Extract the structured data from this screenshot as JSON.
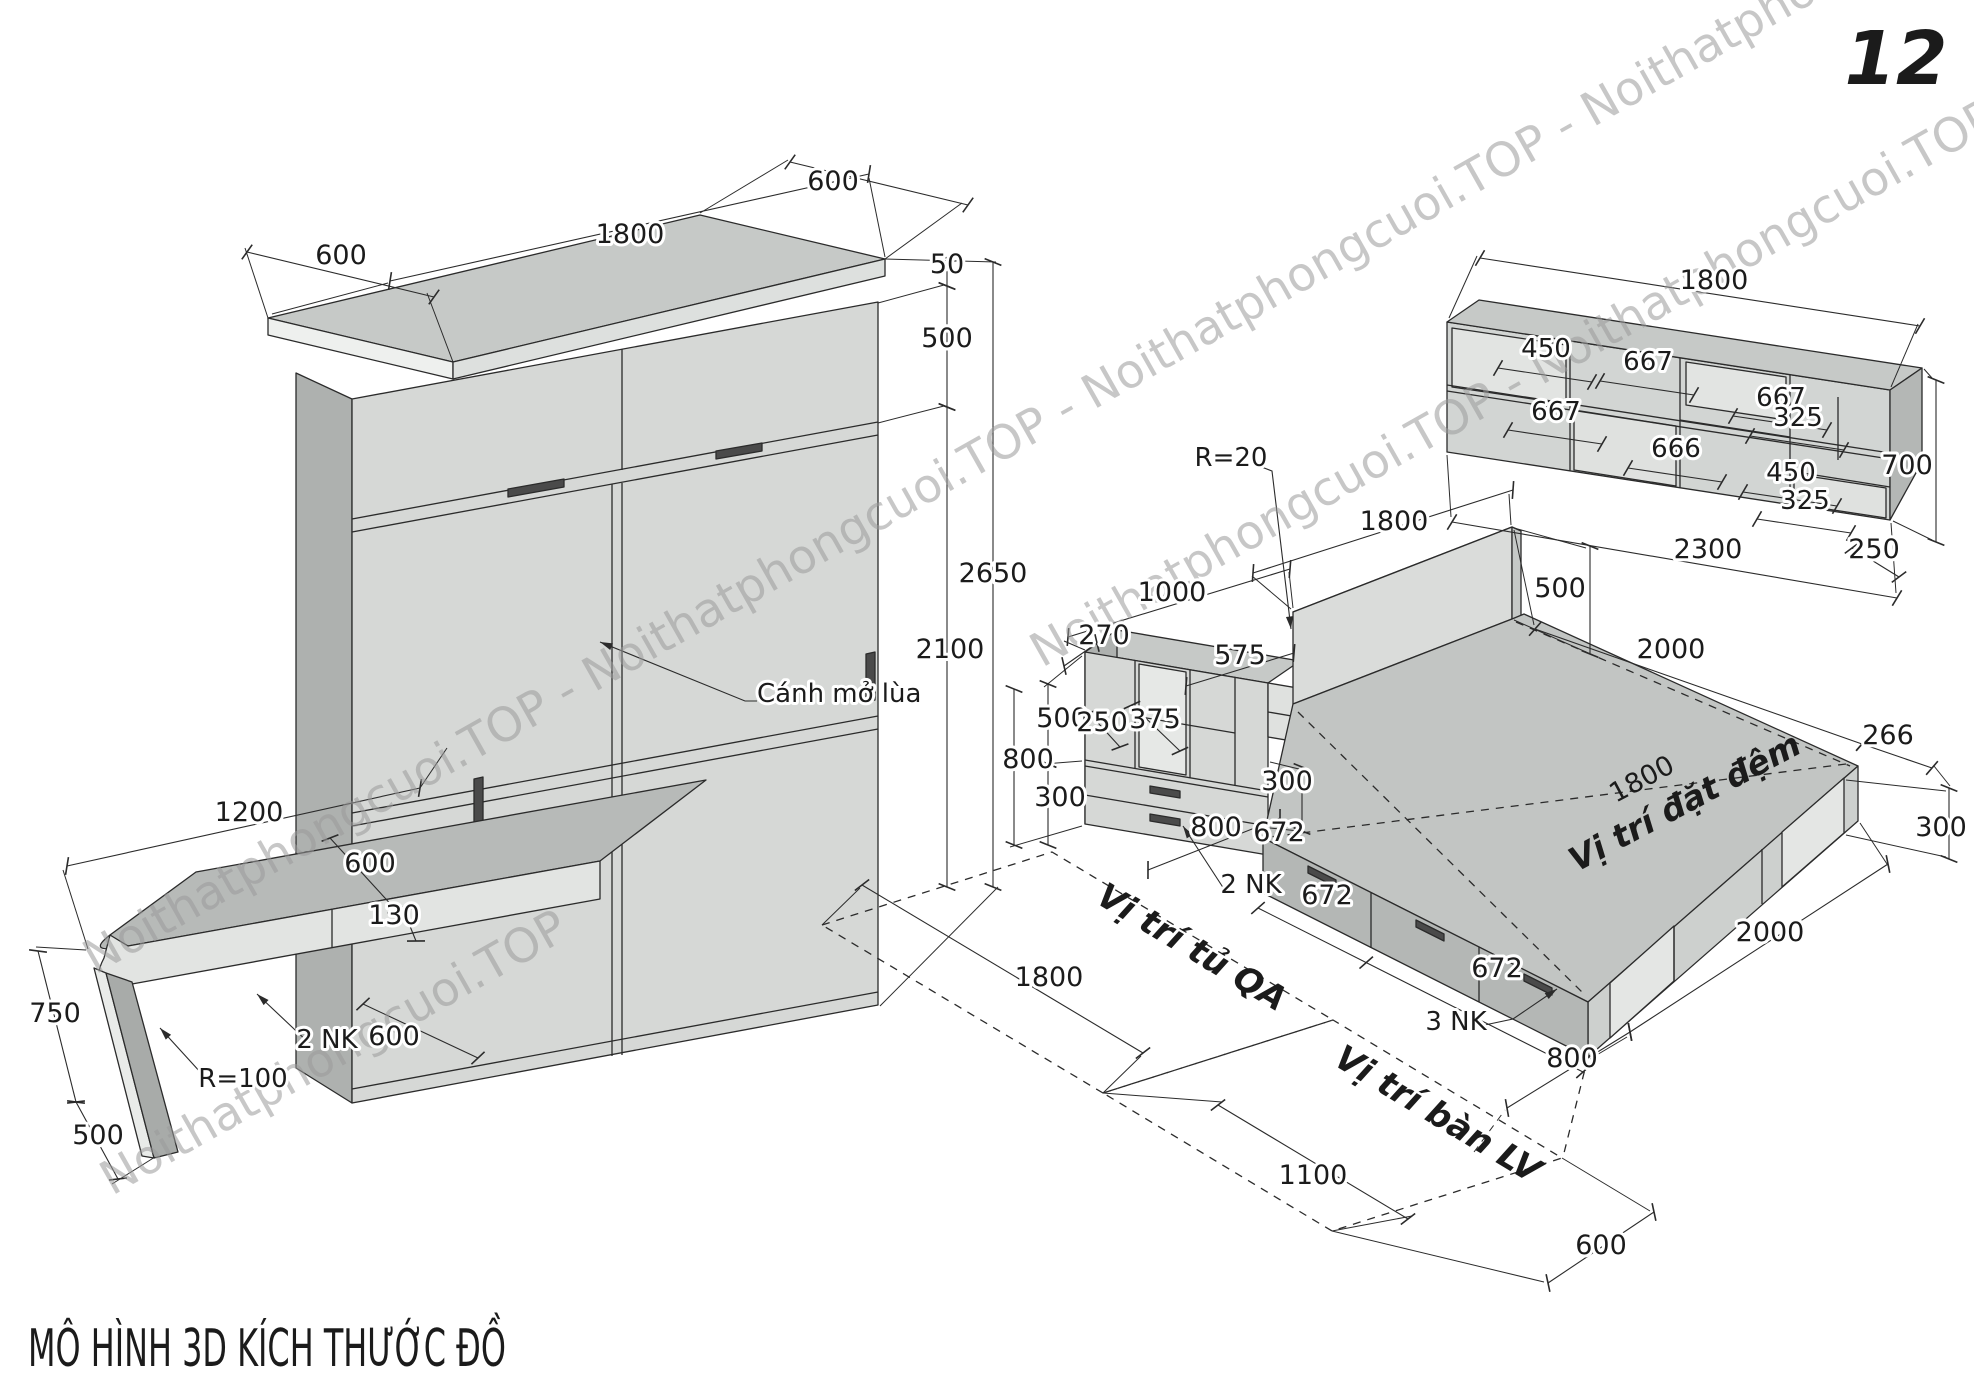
{
  "page": {
    "number": "12",
    "title": "MÔ HÌNH 3D KÍCH THƯỚC ĐỒ"
  },
  "watermark": {
    "text": "Noithatphongcuoi.TOP",
    "color": "#9b9b9b"
  },
  "wardrobe": {
    "depth_left": "600",
    "width": "1800",
    "depth_right": "600",
    "top": "50",
    "upper": "500",
    "height": "2650",
    "door": "2100",
    "note": "Cánh mở lùa"
  },
  "desk": {
    "length": "1200",
    "depth": "600",
    "apron": "130",
    "height": "750",
    "leg": "500",
    "drawers": "2 NK",
    "radius": "R=100",
    "gap": "600"
  },
  "qa": {
    "radius": "R=20",
    "width": "1000",
    "depth": "270",
    "shelf": "575",
    "shelf_h": "500",
    "c250": "250",
    "c375": "375",
    "h800": "800",
    "h300": "300",
    "d300": "300",
    "floor": "800",
    "drawers": "2 NK"
  },
  "bed": {
    "headboard_w": "1800",
    "headboard_h": "500",
    "length": "2000",
    "end": "266",
    "side": "300",
    "mattress_w": "1800",
    "mattress": "Vị trí đặt đệm",
    "drawer1": "672",
    "drawer2": "672",
    "drawer3": "672",
    "drawers": "3 NK",
    "foot": "800",
    "foot_depth": "600",
    "length2": "2000"
  },
  "floor": {
    "qa": "Vị trí tủ QA",
    "lv": "Vị trí bàn LV",
    "width": "1800",
    "depth": "1100"
  },
  "shelf": {
    "width": "1800",
    "height": "700",
    "total": "2300",
    "depth": "250",
    "c450a": "450",
    "c667a": "667",
    "c667b": "667",
    "c667c": "667",
    "c325a": "325",
    "c666": "666",
    "c450b": "450",
    "c325b": "325"
  }
}
